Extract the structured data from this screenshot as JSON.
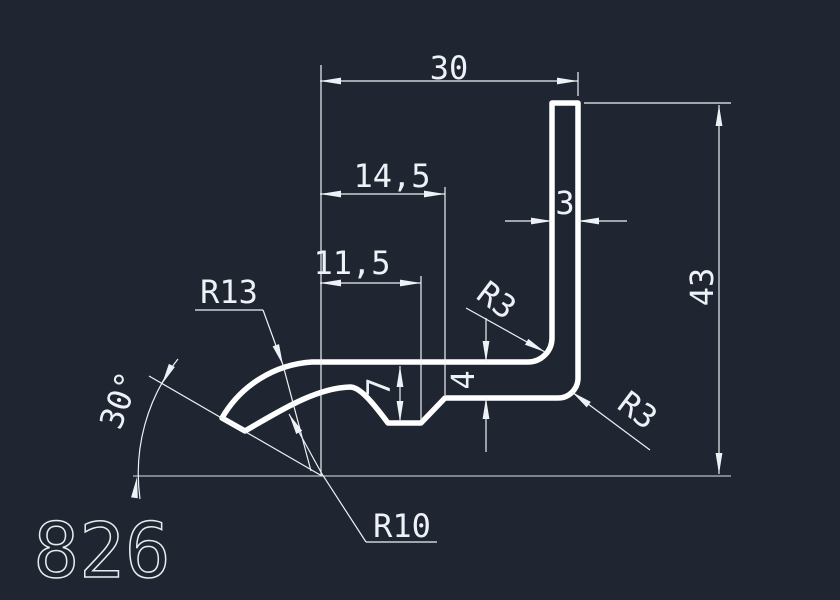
{
  "drawing": {
    "part_number": "826",
    "colors": {
      "background": "#1f2631",
      "profile_line": "#ffffff",
      "dimension_line": "#eef2f6",
      "ground_line": "#b4bcc5"
    },
    "dimensions": {
      "top_width": "30",
      "groove_far_offset": "14,5",
      "groove_near_offset": "11,5",
      "wall_thickness": "3",
      "total_height": "43",
      "groove_depth": "7",
      "flange_thickness": "4",
      "left_outer_radius": "R13",
      "left_inner_radius": "R10",
      "inner_fillet_radius": "R3",
      "corner_radius": "R3",
      "end_angle": "30°"
    }
  }
}
